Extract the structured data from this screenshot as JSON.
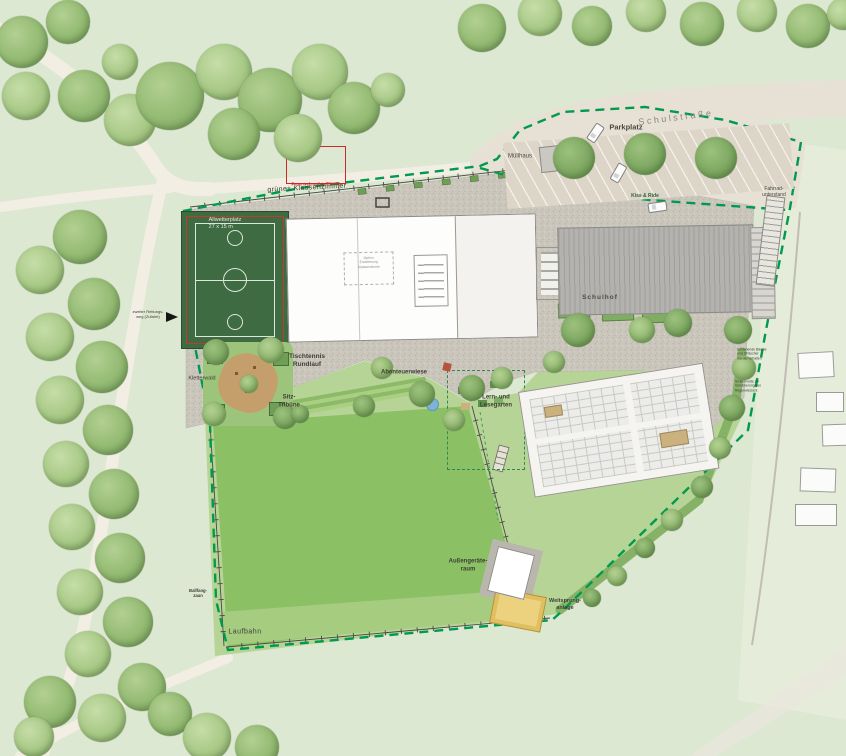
{
  "labels": {
    "schulstrasse": "Schulstraße",
    "parkplatz": "Parkplatz",
    "muellhaus": "Müllhaus",
    "kiss_and_ride": "Kiss & Ride",
    "fahrradunterstand": "Fahrrad-\nunterstand",
    "feuerwehr": "Feuerwehraufstellfläche",
    "gruenes_klassenzimmer": "grünes Klassenzimmer",
    "allwetterplatz": "Allwetterplatz\n27 x 15 m",
    "kletterwald": "Kletterwald",
    "tischtennis": "Tischtennis\nRundlauf",
    "sitztribuene": "Sitz-\nTribüne",
    "abenteuerwiese": "Abenteuerwiese",
    "lesegarten": "Lern- und\nLesegarten",
    "schulhof": "Schulhof",
    "ballfangzaun": "Ballfang-\nzaun",
    "laufbahn": "Laufbahn",
    "aussengeraeteraum": "Außengeräte-\nraum",
    "weitsprunganlage": "Weitsprung-\nanlage",
    "rettungsweg": "zweiter Rettungs-\nweg (Zufahrt)",
    "note_hecke": "bestehende Bäume\nund Sträucher\nwerden erhalten",
    "note_mulde": "Sickermulde zur\nVersickerung des\nRegenwassers",
    "erweiterung": "Option\nErweiterung\nKlassenräume"
  },
  "colors": {
    "boundary": "#009a4e",
    "field": "#8cc065",
    "court": "#3e6b41",
    "gravel": "#cac6bc",
    "street": "#e7e0d4",
    "lawn": "#b7d497",
    "sand": "#e0be62",
    "fire_red": "#cc2a2a"
  }
}
